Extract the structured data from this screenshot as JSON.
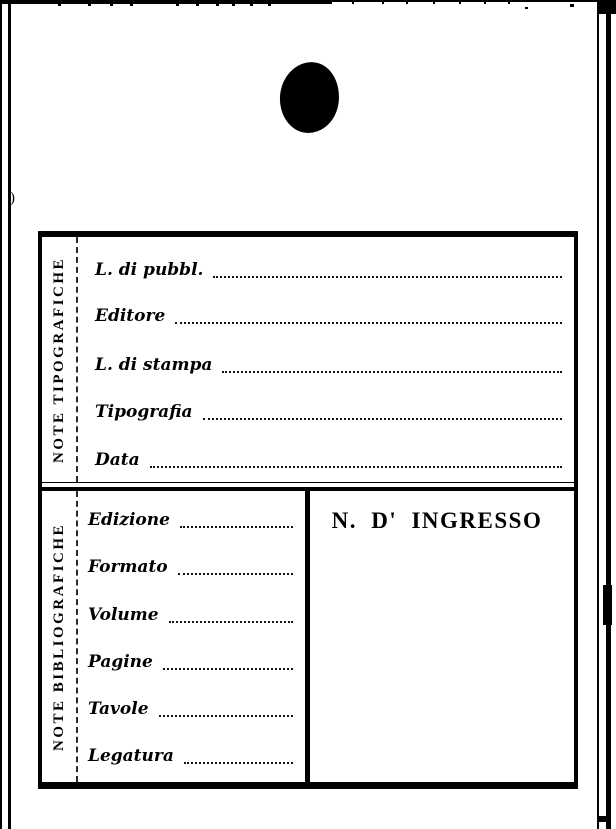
{
  "page": {
    "background": "#ffffff",
    "ink_color": "#000000"
  },
  "card": {
    "sections": [
      {
        "side_label": "NOTE TIPOGRAFICHE",
        "fields": [
          "L. di pubbl.",
          "Editore",
          "L. di stampa",
          "Tipografia",
          "Data"
        ],
        "field_values": [
          "",
          "",
          "",
          "",
          ""
        ]
      },
      {
        "side_label": "NOTE BIBLIOGRAFICHE",
        "fields": [
          "Edizione",
          "Formato",
          "Volume",
          "Pagine",
          "Tavole",
          "Legatura"
        ],
        "field_values": [
          "",
          "",
          "",
          "",
          "",
          ""
        ],
        "ingresso_label": "N. D' INGRESSO",
        "ingresso_value": ""
      }
    ]
  },
  "marks": {
    "paren_artifact": ")"
  }
}
